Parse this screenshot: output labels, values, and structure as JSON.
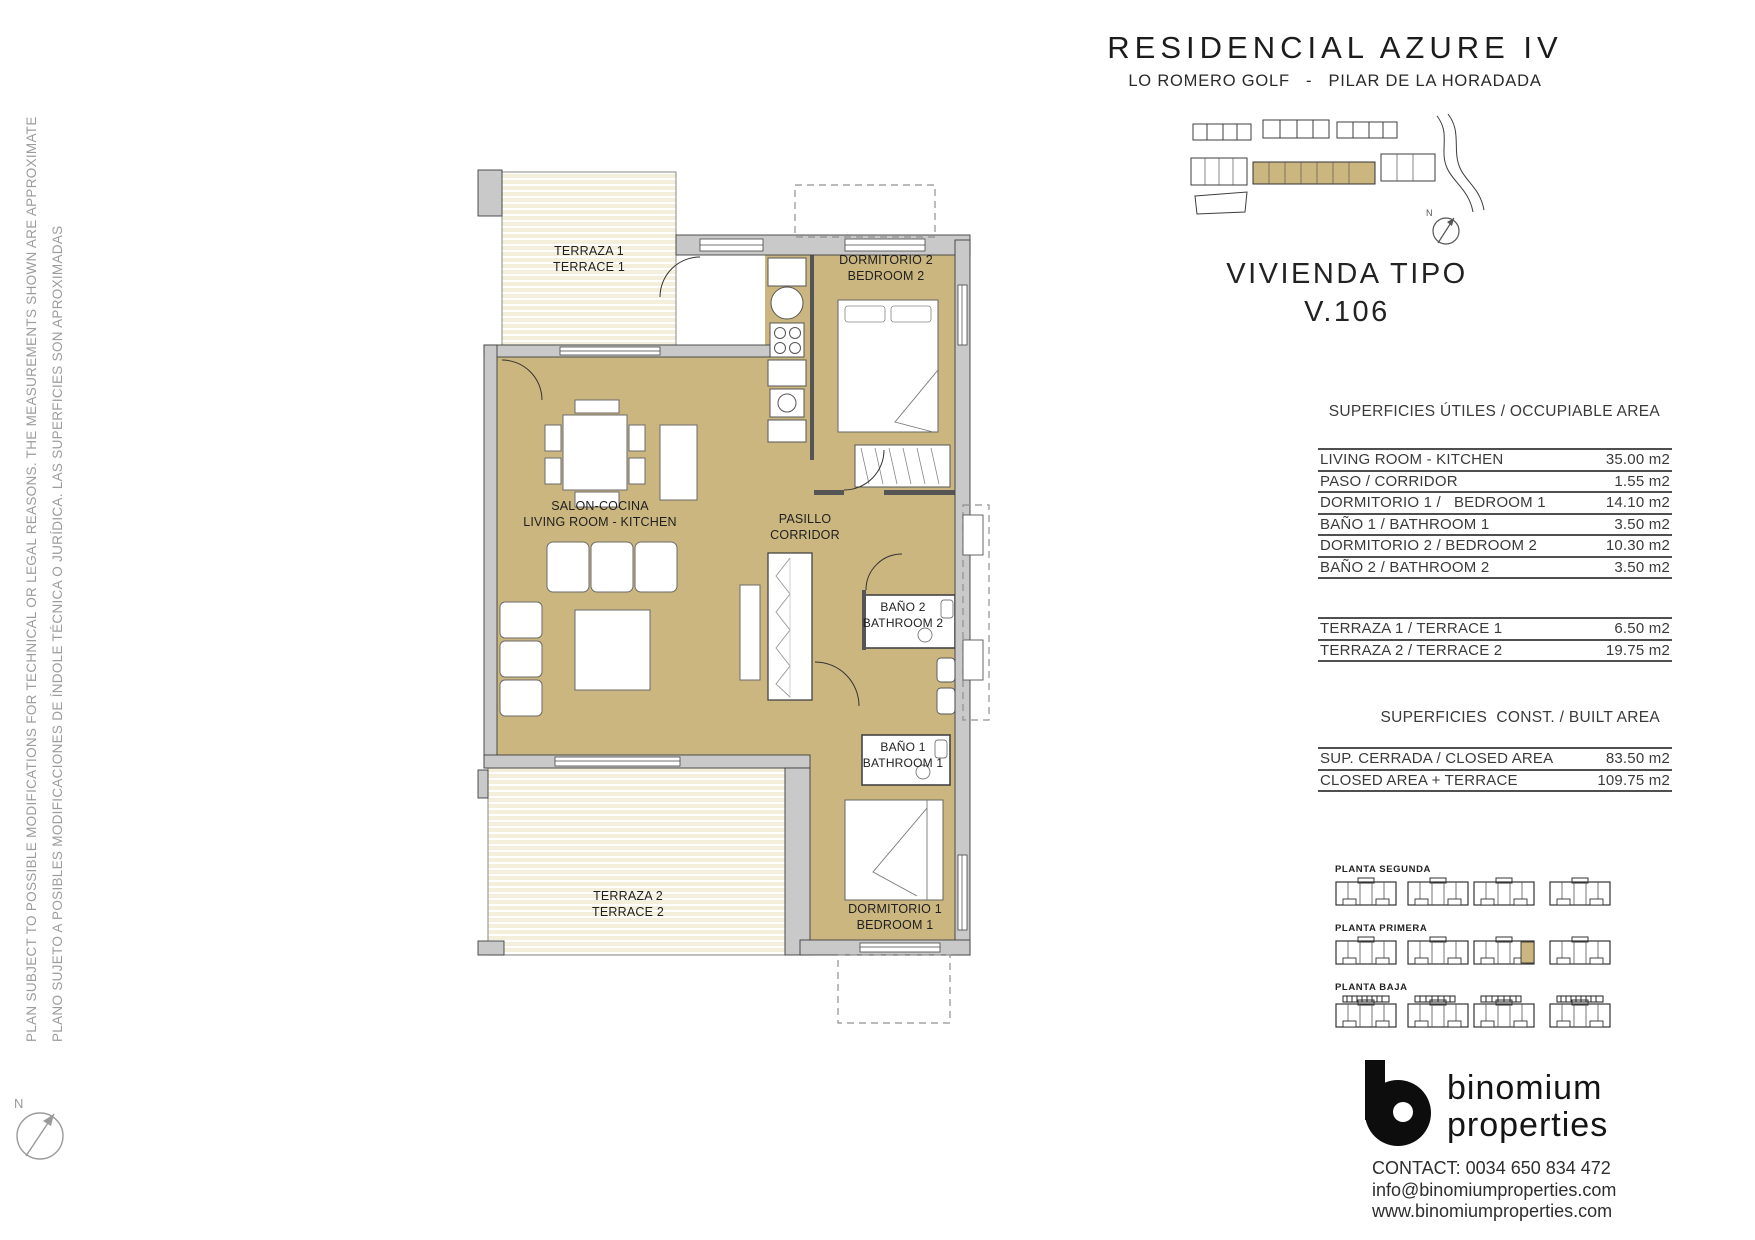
{
  "page": {
    "title": "RESIDENCIAL AZURE IV",
    "subtitle": "LO ROMERO GOLF   -   PILAR DE LA HORADADA"
  },
  "disclaimer": {
    "line_en": "PLAN SUBJECT TO POSSIBLE MODIFICATIONS FOR TECHNICAL OR LEGAL REASONS. THE MEASUREMENTS SHOWN ARE APPROXIMATE",
    "line_es": "PLANO SUJETO A POSIBLES MODIFICACIONES DE ÍNDOLE TÉCNICA O JURÍDICA. LAS SUPERFICIES SON APROXIMADAS"
  },
  "unit": {
    "label": "VIVIENDA TIPO",
    "number": "V.106"
  },
  "floor_plan": {
    "rooms": {
      "terraza1": {
        "es": "TERRAZA 1",
        "en": "TERRACE 1"
      },
      "terraza2": {
        "es": "TERRAZA 2",
        "en": "TERRACE 2"
      },
      "salon": {
        "es": "SALON-COCINA",
        "en": "LIVING ROOM - KITCHEN"
      },
      "pasillo": {
        "es": "PASILLO",
        "en": "CORRIDOR"
      },
      "dormitorio1": {
        "es": "DORMITORIO 1",
        "en": "BEDROOM 1"
      },
      "dormitorio2": {
        "es": "DORMITORIO 2",
        "en": "BEDROOM 2"
      },
      "bano1": {
        "es": "BAÑO 1",
        "en": "BATHROOM 1"
      },
      "bano2": {
        "es": "BAÑO 2",
        "en": "BATHROOM 2"
      }
    }
  },
  "occupiable": {
    "header": "SUPERFICIES ÚTILES / OCCUPIABLE AREA",
    "rows": [
      {
        "label": "LIVING ROOM - KITCHEN",
        "value": "35.00 m2"
      },
      {
        "label": "PASO / CORRIDOR",
        "value": "1.55 m2"
      },
      {
        "label": "DORMITORIO 1 /   BEDROOM 1",
        "value": "14.10 m2"
      },
      {
        "label": "BAÑO 1 / BATHROOM 1",
        "value": "3.50 m2"
      },
      {
        "label": "DORMITORIO 2 / BEDROOM 2",
        "value": "10.30 m2"
      },
      {
        "label": "BAÑO 2 / BATHROOM 2",
        "value": "3.50 m2"
      }
    ]
  },
  "terraces": {
    "rows": [
      {
        "label": "TERRAZA 1 / TERRACE 1",
        "value": "6.50 m2"
      },
      {
        "label": "TERRAZA 2 / TERRACE 2",
        "value": "19.75 m2"
      }
    ]
  },
  "built": {
    "header": "SUPERFICIES  CONST. / BUILT AREA",
    "rows": [
      {
        "label": "SUP. CERRADA / CLOSED AREA",
        "value": "83.50 m2"
      },
      {
        "label": "CLOSED AREA + TERRACE",
        "value": "109.75 m2"
      }
    ]
  },
  "floors": {
    "segunda": "PLANTA SEGUNDA",
    "primera": "PLANTA PRIMERA",
    "baja": "PLANTA BAJA"
  },
  "brand": {
    "name_line1": "binomium",
    "name_line2": "properties"
  },
  "contact": {
    "phone": "CONTACT: 0034 650 834 472",
    "email": "info@binomiumproperties.com",
    "web": "www.binomiumproperties.com"
  },
  "compass": {
    "label": "N"
  },
  "colors": {
    "accent_tan": "#cbb67f",
    "terrace_cream": "#f4efda",
    "wall_gray": "#c9c9c9"
  }
}
